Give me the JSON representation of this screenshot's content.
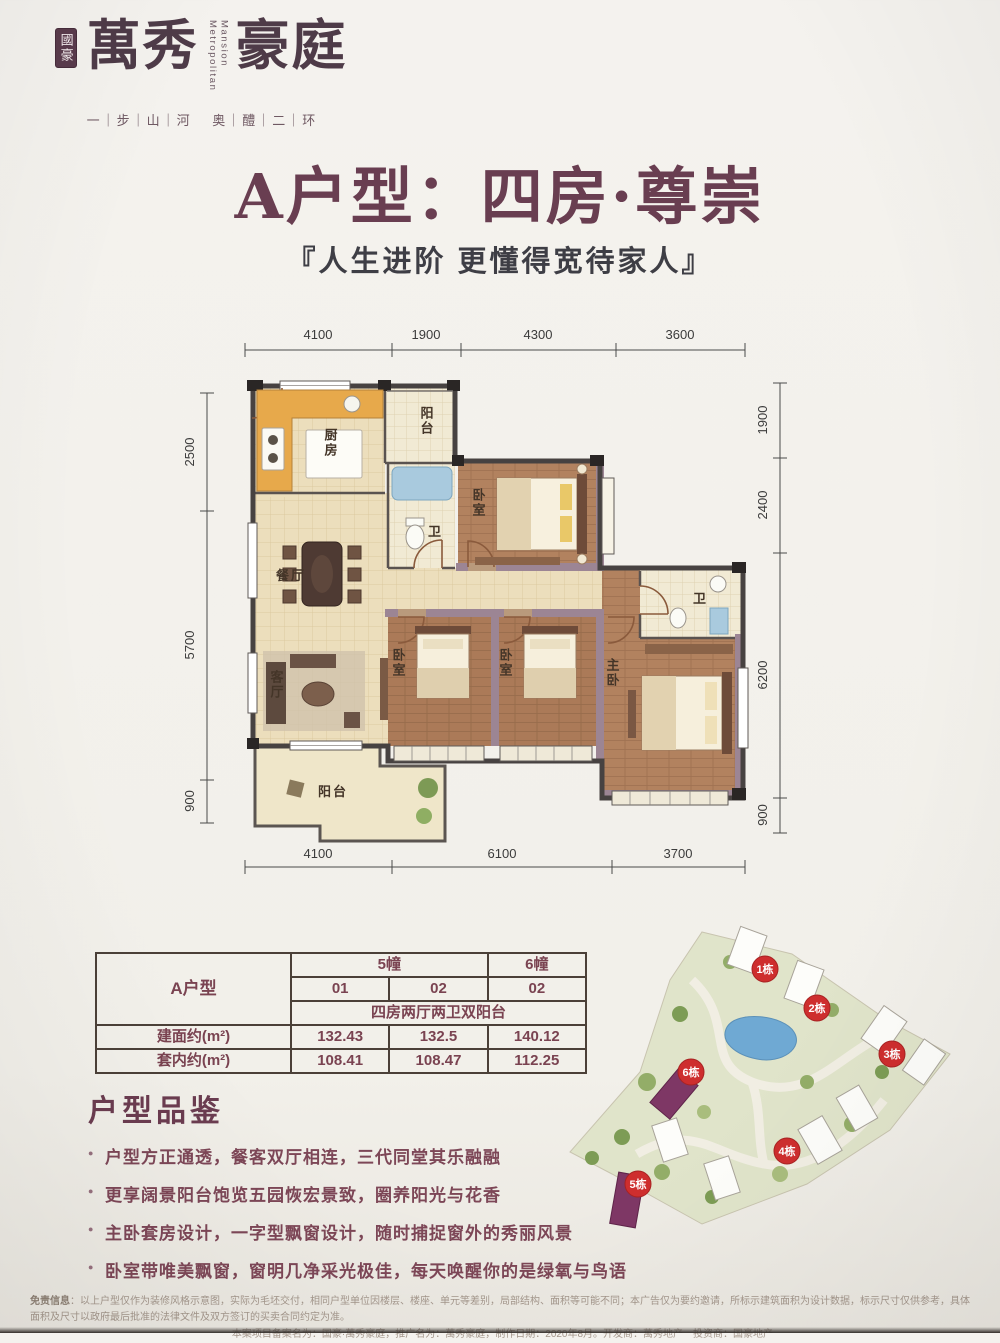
{
  "brand": {
    "seal_text": "國豪",
    "logo_cn_1": "萬",
    "logo_cn_2": "秀",
    "logo_cn_3": "豪",
    "logo_cn_4": "庭",
    "logo_en_1": "Metropolitan",
    "logo_en_2": "Mansion",
    "tagline": "一｜步｜山｜河　 奥｜醴｜二｜环"
  },
  "header": {
    "title": "A户型：四房·尊崇",
    "subtitle": "『人生进阶  更懂得宽待家人』"
  },
  "floorplan": {
    "rooms": {
      "kitchen": "厨房",
      "balcony_top": "阳台",
      "bath1": "卫",
      "bedroom_top": "卧室",
      "dining": "餐厅",
      "living": "客厅",
      "bedroom2": "卧室",
      "bedroom3": "卧室",
      "master": "主卧",
      "bath2": "卫",
      "balcony_bottom": "阳台"
    },
    "dims": {
      "top": [
        "4100",
        "1900",
        "4300",
        "3600"
      ],
      "bottom": [
        "4100",
        "6100",
        "3700"
      ],
      "left": [
        "2500",
        "5700",
        "900"
      ],
      "right": [
        "1900",
        "2400",
        "6200",
        "900"
      ]
    }
  },
  "spec_table": {
    "type_label": "A户型",
    "block_5": "5幢",
    "block_6": "6幢",
    "unit_row": [
      "01",
      "02",
      "02"
    ],
    "layout_desc": "四房两厅两卫双阳台",
    "rows": [
      {
        "label": "建面约(m²)",
        "values": [
          "132.43",
          "132.5",
          "140.12"
        ]
      },
      {
        "label": "套内约(m²)",
        "values": [
          "108.41",
          "108.47",
          "112.25"
        ]
      }
    ]
  },
  "features": {
    "heading": "户型品鉴",
    "items": [
      "户型方正通透，餐客双厅相连，三代同堂其乐融融",
      "更享阔景阳台饱览五园恢宏景致，圈养阳光与花香",
      "主卧套房设计，一字型飘窗设计，随时捕捉窗外的秀丽风景",
      "卧室带唯美飘窗，窗明几净采光极佳，每天唤醒你的是绿氧与鸟语"
    ]
  },
  "sitemap": {
    "badges": [
      "1栋",
      "2栋",
      "3栋",
      "4栋",
      "5栋",
      "6栋"
    ]
  },
  "disclaimer": {
    "label": "免责信息",
    "line1": "：以上户型仅作为装修风格示意图，实际为毛坯交付，相同户型单位因楼层、楼座、单元等差别，局部结构、面积等可能不同；本广告仅为要约邀请，所标示建筑面积为设计数据，标示尺寸仅供参考，具体面积及尺寸以政府最后批准的法律文件及双方签订的买卖合同约定为准。",
    "line2": "本案项目备案名为：国豪·萬秀豪庭，推广名为：萬秀豪庭，制作日期：2020年8月。开发商：萬秀地产　投资商：国豪地产"
  },
  "colors": {
    "accent_maroon": "#693e51",
    "badge_red": "#ce2e2e",
    "highlight_purple": "#7e3765",
    "wall_dark": "#474241",
    "wall_purple": "#9c8594"
  }
}
